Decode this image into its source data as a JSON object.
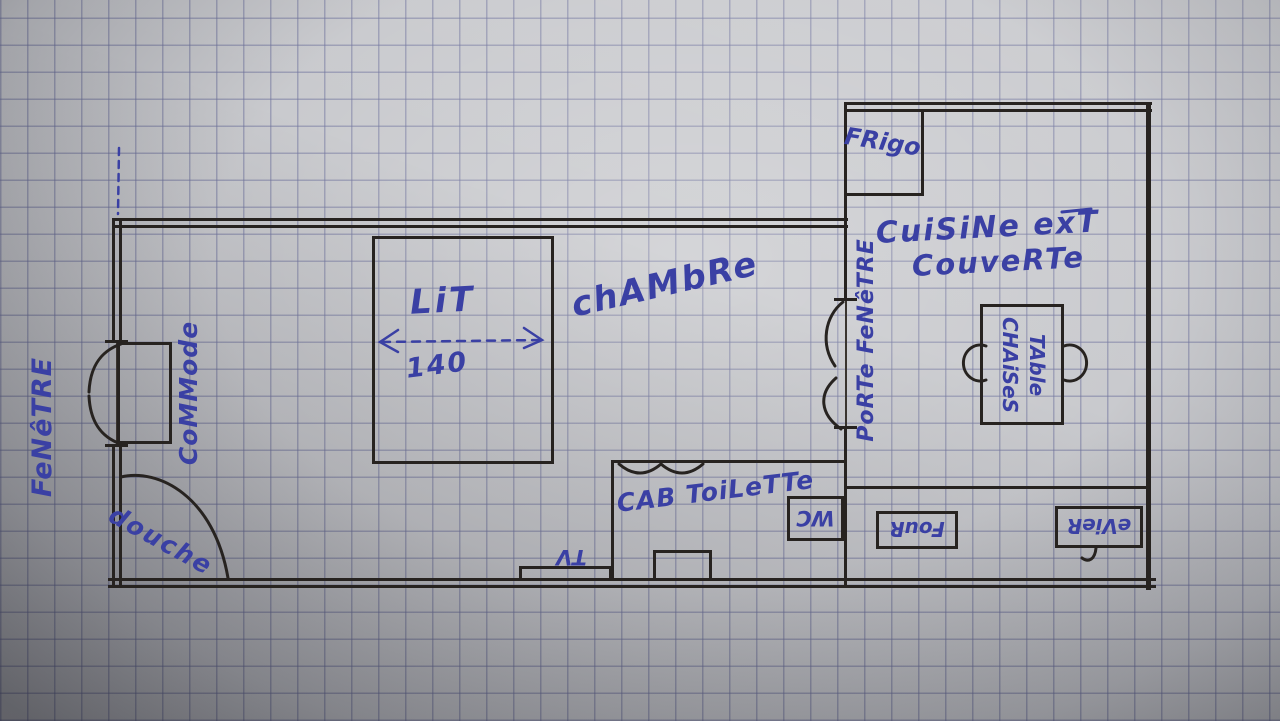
{
  "scene": {
    "description": "hand-drawn apartment floor plan in ink on squared graph paper",
    "rooms": [
      "chambre",
      "cab toilette",
      "cuisine ext couverte"
    ]
  },
  "labels": {
    "fenetre": "FeNêTRE",
    "commode": "CoMMode",
    "douche": "douche",
    "lit": "LiT",
    "lit_width": "140",
    "chambre": "chAMbRe",
    "cab_toilette": "CAB ToiLeTTe",
    "tv": "TV",
    "wc": "WC",
    "porte_fenetre": "PoRTe FeNêTRE",
    "frigo": "FRigo",
    "cuisine_line1": "CuiSiNe exT",
    "cuisine_line2": "CouveRTe",
    "table": "TAble",
    "chaises": "CHAiSeS",
    "four": "FouR",
    "evier": "eVieR"
  },
  "colors": {
    "ink_blue": "#3a40a4",
    "ink_black": "#272320",
    "paper": "#c6c7cb",
    "grid": "#686c98"
  }
}
